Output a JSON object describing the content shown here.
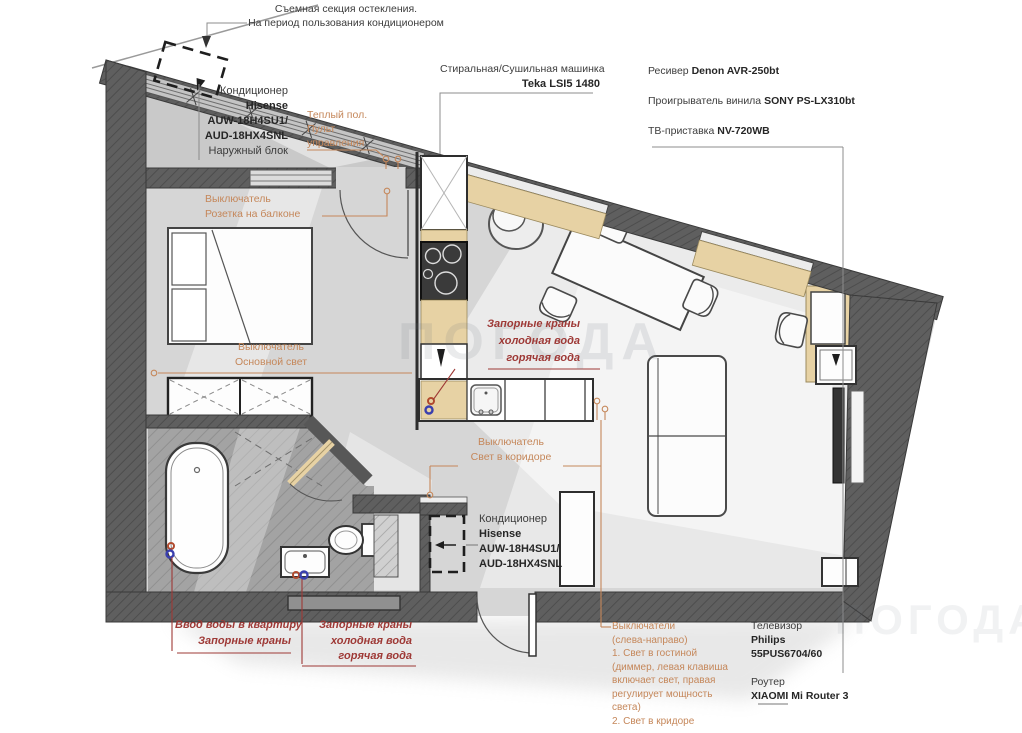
{
  "colors": {
    "accent_orange": "#c5875a",
    "accent_red": "#9e3936",
    "wall_gray": "#5f5f5f",
    "floor_gray": "#d6d6d6",
    "wood_tan": "#e7d2a4",
    "text_dark": "#3c3c3c",
    "valve_cold_blue": "#3a3fae",
    "valve_hot_red": "#b14a2e"
  },
  "watermark": "ПОГОДА",
  "labels": {
    "glazing_note": {
      "line1": "Съемная секция остекления.",
      "line2": "На период пользования кондиционером"
    },
    "ac_outdoor": {
      "title": "Кондиционер",
      "brand": "Hisense",
      "model1": "AUW-18H4SU1/",
      "model2": "AUD-18HX4SNL",
      "note": "Наружный блок"
    },
    "warm_floor": {
      "line1": "Теплый пол.",
      "line2": "Пульт",
      "line3": "управления"
    },
    "balcony_socket": {
      "line1": "Выключатель",
      "line2": "Розетка на балконе"
    },
    "washer": {
      "line1": "Стиральная/Сушильная машинка",
      "line2": "Teka LSI5 1480"
    },
    "receiver": {
      "label": "Ресивер",
      "model": "Denon AVR-250bt"
    },
    "vinyl_player": {
      "label": "Проигрыватель винила",
      "model": "SONY PS-LX310bt"
    },
    "tv_box": {
      "label": "ТВ-приставка",
      "model": "NV-720WB"
    },
    "kitchen_valves": {
      "line1": "Запорные краны",
      "line2": "холодная вода",
      "line3": "горячая вода"
    },
    "main_light_switch": {
      "line1": "Выключатель",
      "line2": "Основной свет"
    },
    "corridor_light_switch": {
      "line1": "Выключатель",
      "line2": "Свет в коридоре"
    },
    "ac_indoor": {
      "title": "Кондиционер",
      "brand": "Hisense",
      "model1": "AUW-18H4SU1/",
      "model2": "AUD-18HX4SNL"
    },
    "water_inlet": {
      "line1": "Ввод воды в квартиру",
      "line2": "Запорные краны"
    },
    "bathroom_valves": {
      "line1": "Запорные краны",
      "line2": "холодная вода",
      "line3": "горячая вода"
    },
    "switch_block_note": {
      "line1": "Выключатели",
      "line2": "(слева-направо)",
      "line3": "1. Свет в гостиной",
      "line4": "(диммер, левая клавиша",
      "line5": "включает свет, правая",
      "line6": "регулирует мощность",
      "line7": "света)",
      "line8": "2. Свет в кридоре"
    },
    "tv": {
      "label": "Телевизор",
      "brand": "Philips",
      "model": "55PUS6704/60"
    },
    "router": {
      "label": "Роутер",
      "model": "XIAOMI Mi Router 3"
    }
  }
}
